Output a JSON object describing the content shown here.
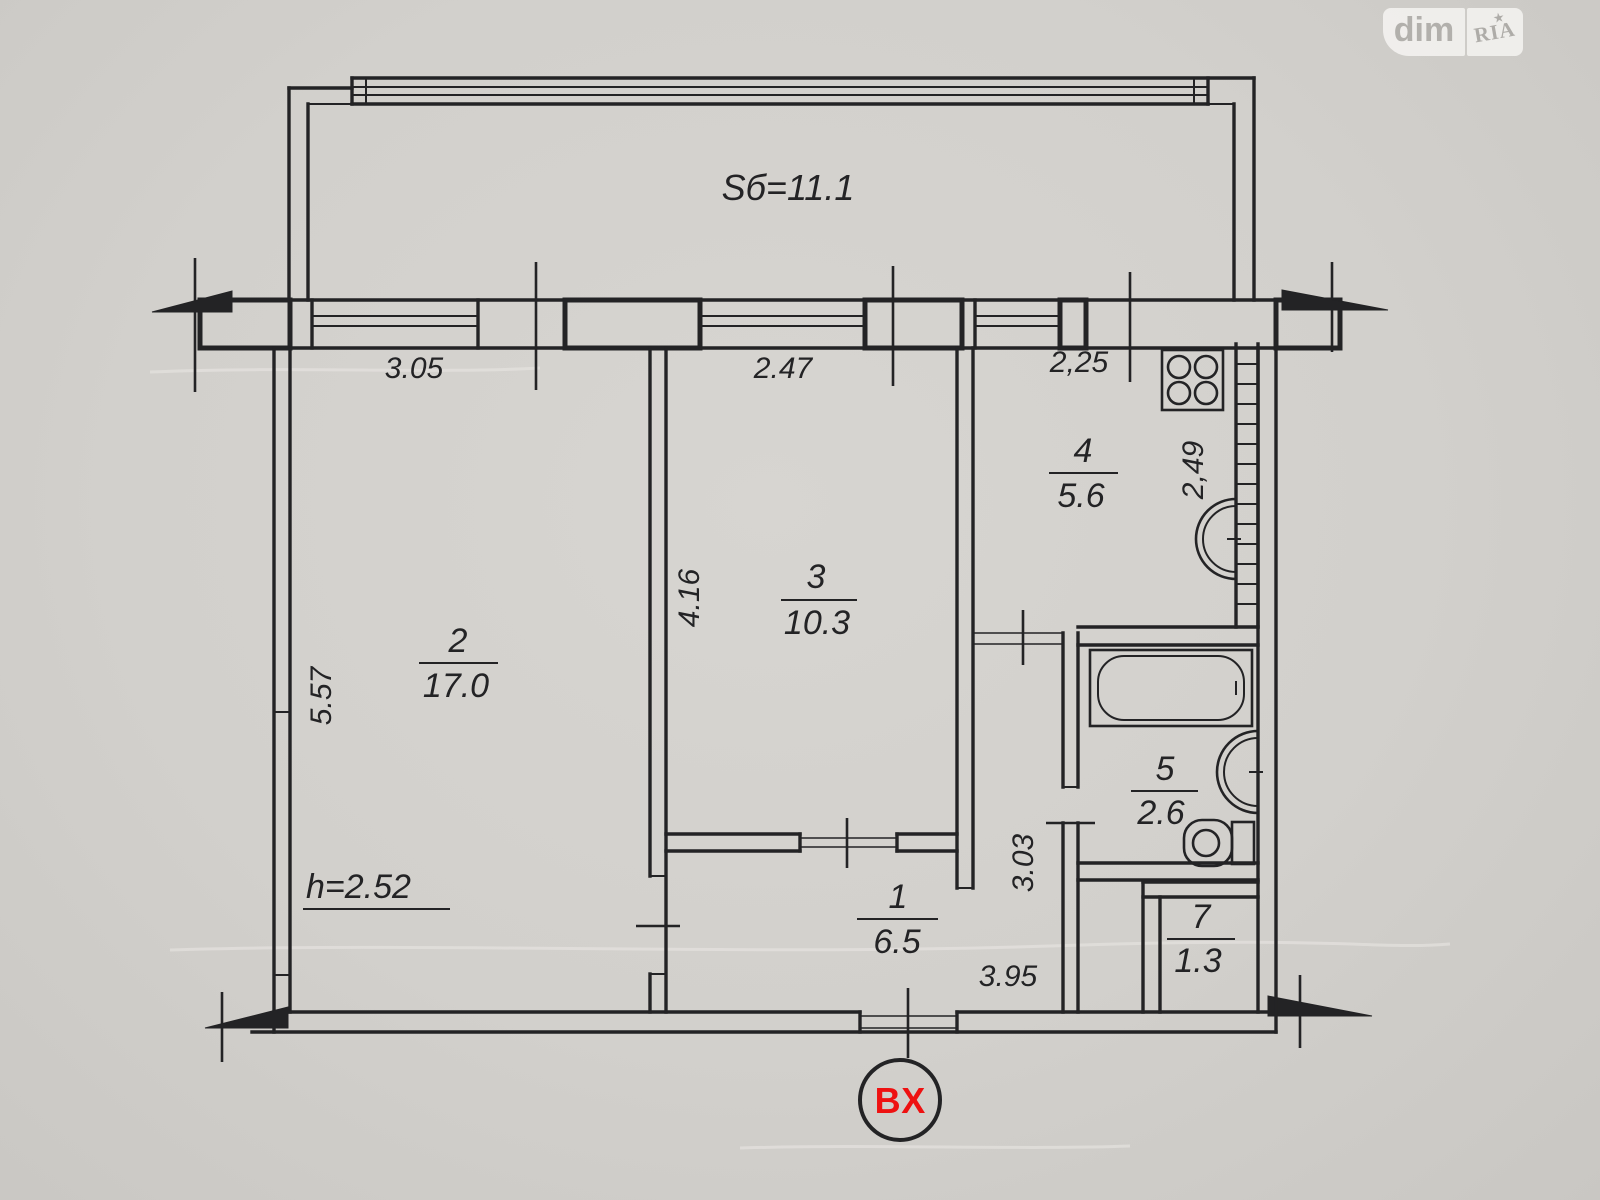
{
  "watermark": {
    "dim": "dim",
    "ria": "RIA",
    "star": "★"
  },
  "balcony": {
    "label": "Sб=11.1"
  },
  "ceiling_height_label": "h=2.52",
  "entrance": {
    "label": "ВХ"
  },
  "rooms": {
    "hallway": {
      "number": "1",
      "area": "6.5"
    },
    "living": {
      "number": "2",
      "area": "17.0"
    },
    "bedroom": {
      "number": "3",
      "area": "10.3"
    },
    "kitchen": {
      "number": "4",
      "area": "5.6"
    },
    "bathroom": {
      "number": "5",
      "area": "2.6"
    },
    "storage": {
      "number": "7",
      "area": "1.3"
    }
  },
  "dimensions": {
    "top_left": "3.05",
    "top_middle": "2.47",
    "top_right": "2,25",
    "left_wall": "5.57",
    "bedroom_left": "4.16",
    "kitchen_right": "2,49",
    "hall_vertical": "3.03",
    "bottom": "3.95"
  },
  "colors": {
    "paper": "#d2d0cc",
    "ink": "#232325",
    "entrance_red": "#ee1111",
    "watermark_text": "#aeaca8"
  }
}
